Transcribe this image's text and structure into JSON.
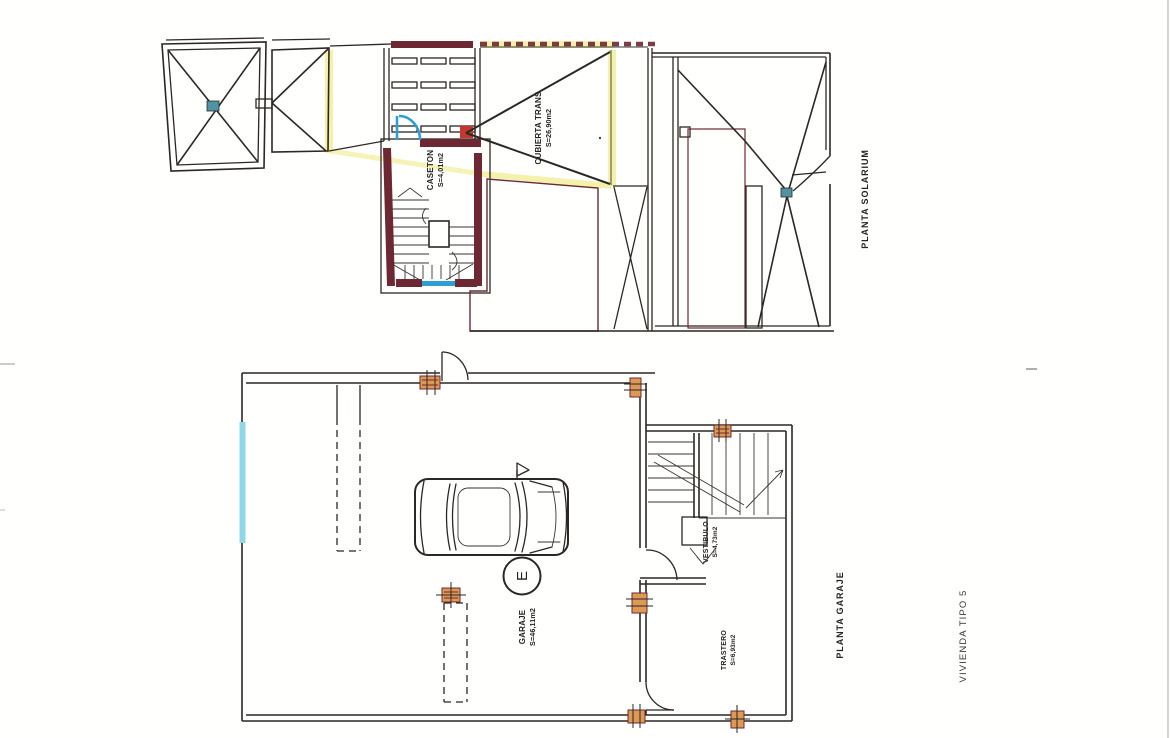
{
  "document": {
    "type_label": "VIVIENDA TIPO 5"
  },
  "colors": {
    "ink": "#2b2724",
    "maroon": "#6d2834",
    "yellow": "#f3efa2",
    "blue": "#2f9fd0",
    "teal": "#4f93a5",
    "red": "#c6372b",
    "orange": "#dc9a55",
    "cyan": "#8fd6e8"
  },
  "solarium_plan": {
    "title": "PLANTA SOLARIUM",
    "rooms": [
      {
        "name": "CASETON",
        "area": "S=4,01m2"
      },
      {
        "name": "CUBIERTA TRANS",
        "area": "S=26,90m2"
      }
    ]
  },
  "garage_plan": {
    "title": "PLANTA GARAJE",
    "elevator_mark": "E",
    "rooms": [
      {
        "name": "GARAJE",
        "area": "S=46,11m2"
      },
      {
        "name": "VESTIBULO",
        "area": "S=4,73m2"
      },
      {
        "name": "TRASTERO",
        "area": "S=6,93m2"
      }
    ]
  }
}
